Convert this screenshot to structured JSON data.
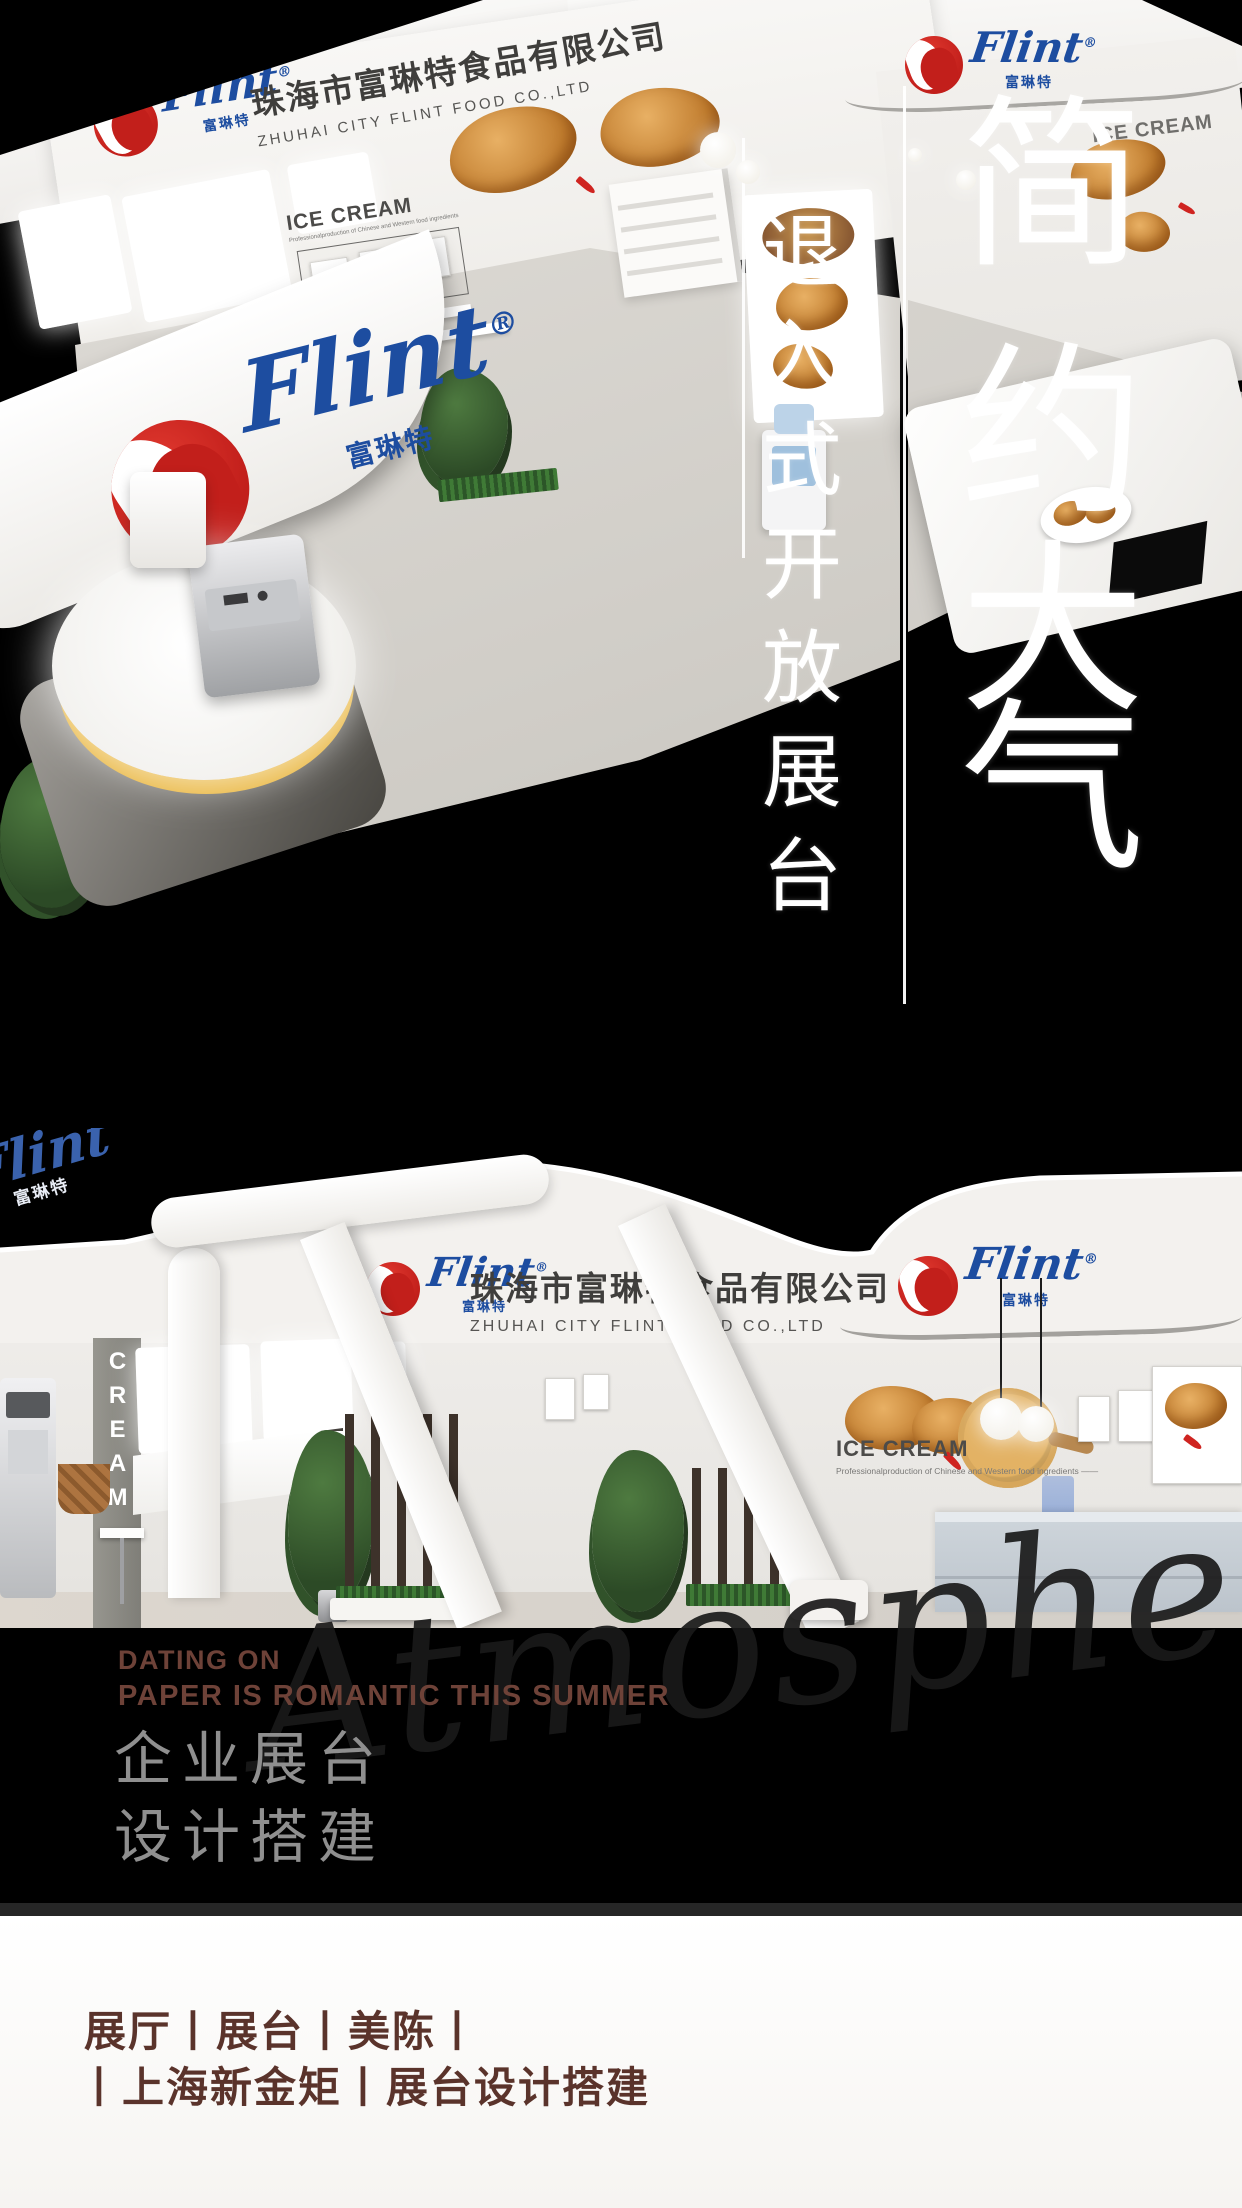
{
  "brand": {
    "script": "Flint",
    "reg": "®",
    "cn": "富琳特"
  },
  "company": {
    "cn": "珠海市富琳特食品有限公司",
    "en": "ZHUHAI CITY FLINT FOOD CO.,LTD"
  },
  "ice_cream": {
    "heading": "ICE CREAM",
    "subline": "Professionalproduction of Chinese and Western food ingredients",
    "subline_dash": "Professionalproduction of Chinese and Western food ingredients ——",
    "vertical": "ICE CREAM"
  },
  "overlay": {
    "main_chars": [
      "简",
      "约",
      "大",
      "气"
    ],
    "sub_chars": [
      "退",
      "入",
      "式",
      "开",
      "放",
      "展",
      "台"
    ]
  },
  "tagline": {
    "line1": "DATING ON",
    "line2": "PAPER IS ROMANTIC THIS SUMMER"
  },
  "service": {
    "line1": "企业展台",
    "line2": "设计搭建"
  },
  "watermark": "Atmosphere",
  "footer": {
    "line1": "展厅丨展台丨美陈丨",
    "line2": "丨上海新金矩丨展台设计搭建"
  },
  "colors": {
    "flint_red": "#c21f1b",
    "flint_blue": "#1d4da0",
    "tagline_brown": "#6e4238",
    "service_gray": "#8f8f8f",
    "footer_brown": "#5a332b",
    "platform_yellow": "#e9b53c"
  }
}
